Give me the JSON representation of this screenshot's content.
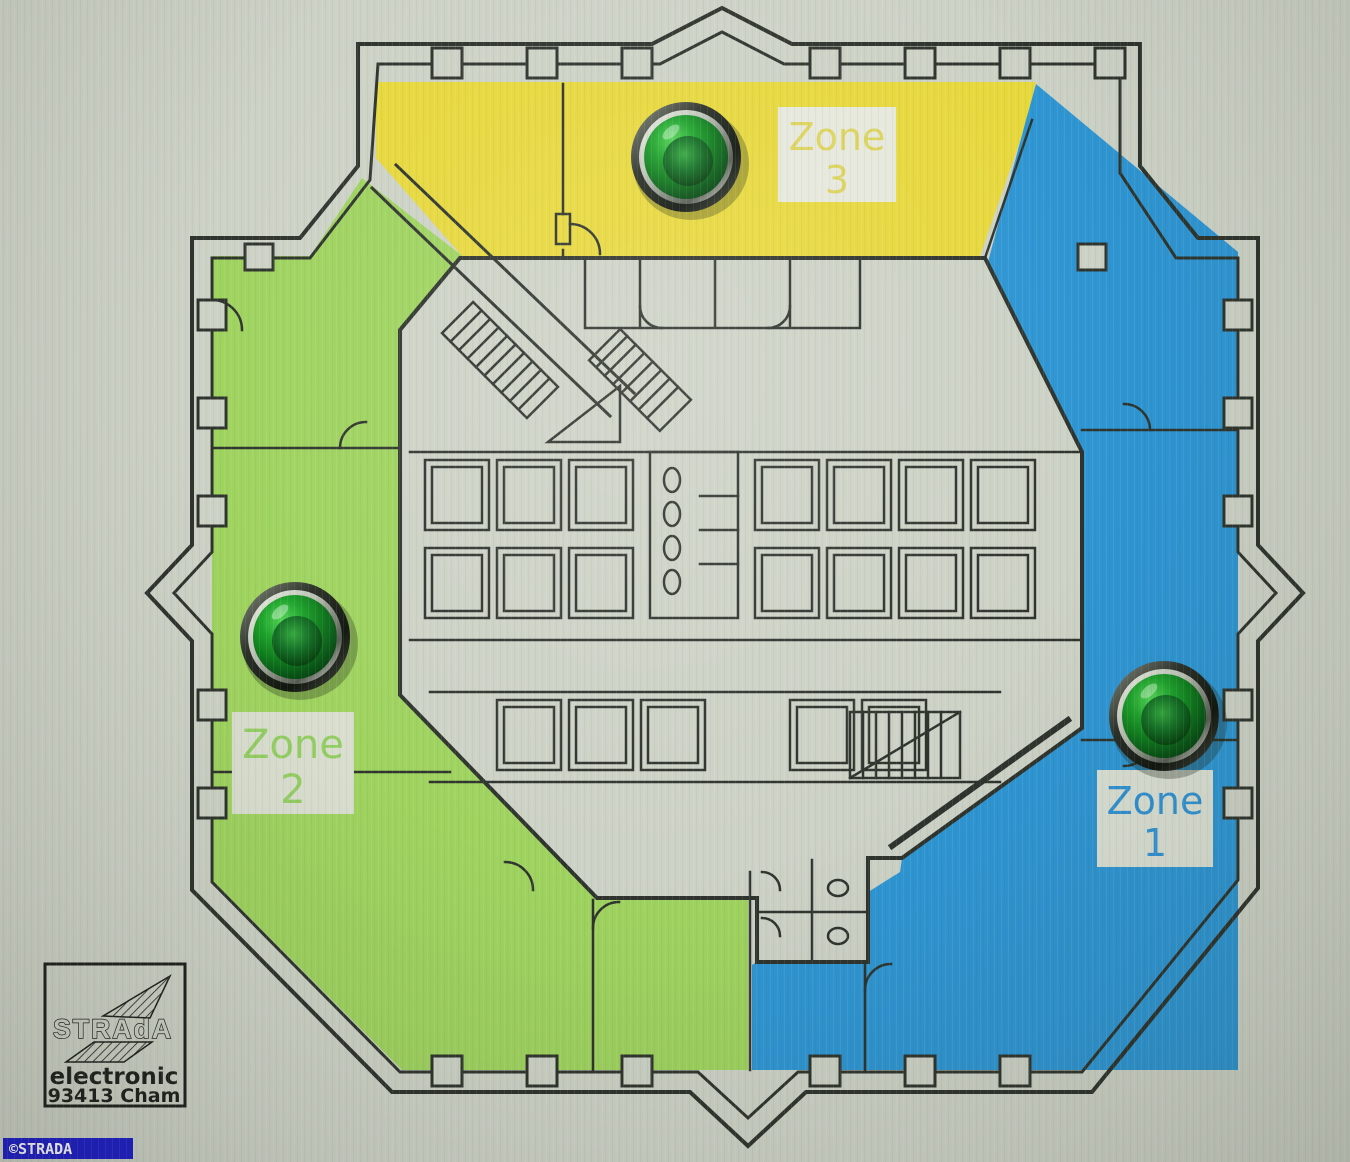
{
  "panel": {
    "background_color": "#cdd2c6",
    "line_color": "#2e342d"
  },
  "zones": [
    {
      "id": "zone-1",
      "label_line1": "Zone",
      "label_line2": "1",
      "fill_color": "#2e96d3",
      "label_text_color": "#3092d2",
      "label_box_color": "#dadfd3"
    },
    {
      "id": "zone-2",
      "label_line1": "Zone",
      "label_line2": "2",
      "fill_color": "#9fd35f",
      "label_text_color": "#93ce62",
      "label_box_color": "#d9decf"
    },
    {
      "id": "zone-3",
      "label_line1": "Zone",
      "label_line2": "3",
      "fill_color": "#e7d83c",
      "label_text_color": "#dcd35b",
      "label_box_color": "#e6e8dc"
    }
  ],
  "leds": {
    "count": 3,
    "lens_bright": "#52d455",
    "lens_mid": "#1ea32c",
    "lens_dark": "#03330a",
    "bezel_color": "#10150e"
  },
  "logo": {
    "brand": "STRAdA",
    "line2": "electronic",
    "line3": "93413 Cham"
  },
  "watermark": {
    "text": "©STRADA",
    "background": "#1e1ec8",
    "text_color": "#ffffff"
  }
}
